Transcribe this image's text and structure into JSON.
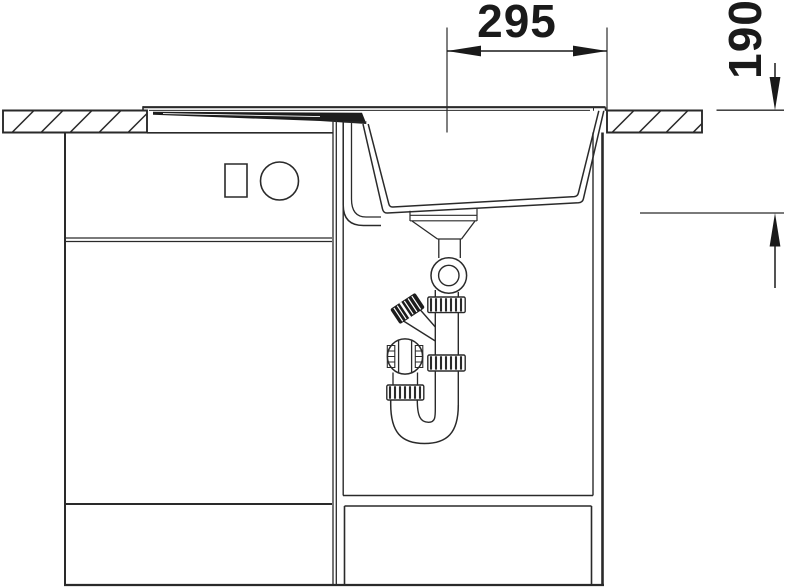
{
  "meta": {
    "description": "Technical cross-section installation drawing of a kitchen sink base cabinet with inset basin, drainboard, drain fitting and pipe trap",
    "units": "mm"
  },
  "dimensions": {
    "drain_offset": {
      "label": "295"
    },
    "basin_depth": {
      "label": "190"
    }
  },
  "colors": {
    "line": "#2a2a2a",
    "dark_fill": "#1d1d1d",
    "background": "#ffffff"
  }
}
